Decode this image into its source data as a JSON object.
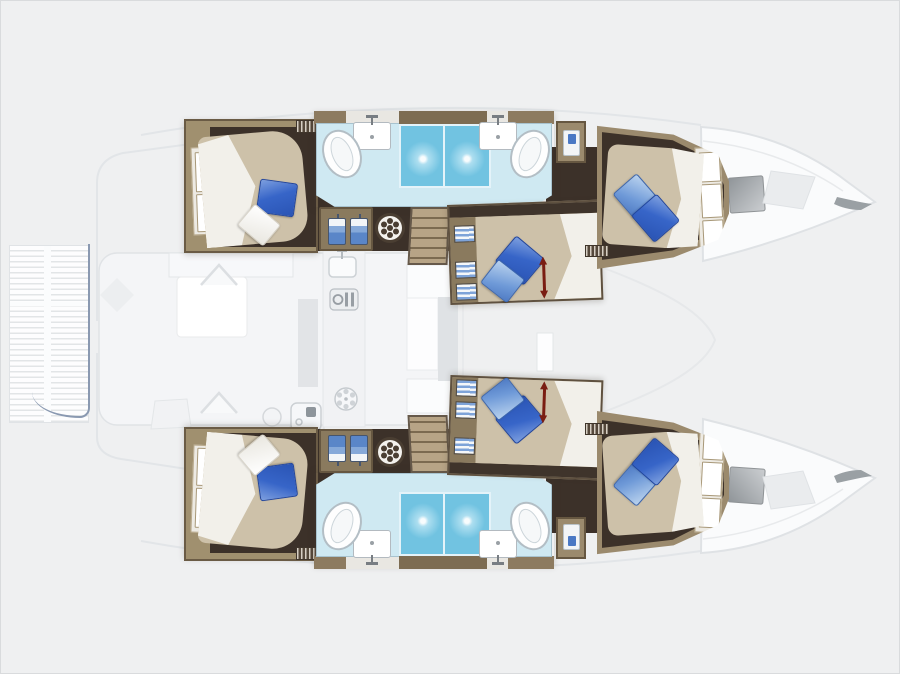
{
  "document": {
    "kind": "catamaran yacht interior floor plan, top-down view",
    "orientation": "bow pointing right, stern at left",
    "visible_text": "none"
  },
  "labels": {
    "plan": "Catamaran layout plan",
    "port_hull": "Port hull (top)",
    "starboard_hull": "Starboard hull (bottom)",
    "aft_cabin": "Aft double cabin",
    "mid_cabin": "Middle double cabin",
    "forward_cabin": "Forward double cabin",
    "bathroom": "Bathroom with toilet, washbasin and shower",
    "salon": "Salon / cockpit (ghosted deck)",
    "galley": "Galley (ghosted)",
    "swim_platform": "Stern swim platform",
    "bow_deck": "Bow deck with hatches"
  },
  "inventory": {
    "hulls": 2,
    "double_cabins": 6,
    "double_beds": 6,
    "bathrooms": 4,
    "toilets": 4,
    "washbasins": 4,
    "showers": 4,
    "wardrobe_locker_symbols": 4,
    "cabin_fan_hatches": 2,
    "staircases": 2,
    "bed_extension_arrows": 2,
    "bow_deck_hatches": 2,
    "blue_pillows": 10,
    "white_pillows": 4
  },
  "icons": {
    "toilet-icon": "tilted white oval bowl",
    "sink-icon": "white rectangle with T faucet",
    "shower-icon": "blue square with light sparkle",
    "wardrobe-icon": "hanging garment on hanger",
    "fan-icon": "dark round hatch with petal dots",
    "stove-icon": "burner glyph on ghost galley",
    "galley-sink-icon": "ghost sink with faucet",
    "grill-icon": "ghost square appliance",
    "companionway-arrow-icon": "up chevron",
    "extension-arrow-icon": "red double-headed arrow",
    "deck-hatch-icon": "gray gradient square",
    "stairs-icon": "laddered treads"
  },
  "palette": {
    "background": "#eff0f1",
    "ghost_outline": "#e0e3e6",
    "platform_edge_blue": "#8a99b1",
    "hull_wall_tan": "#a0906f",
    "cabin_floor_dark_brown": "#3c3129",
    "bed_tan": "#cdc1a9",
    "duvet_white": "#f2f0ea",
    "pillow_blue": "#3765c8",
    "pillow_blue_light": "#6f9ad8",
    "bathroom_floor_light_blue": "#cfe9f2",
    "shower_blue": "#71c3e1",
    "extension_arrow_red": "#7a1d12",
    "hatch_gray": "#9fa3a6"
  }
}
